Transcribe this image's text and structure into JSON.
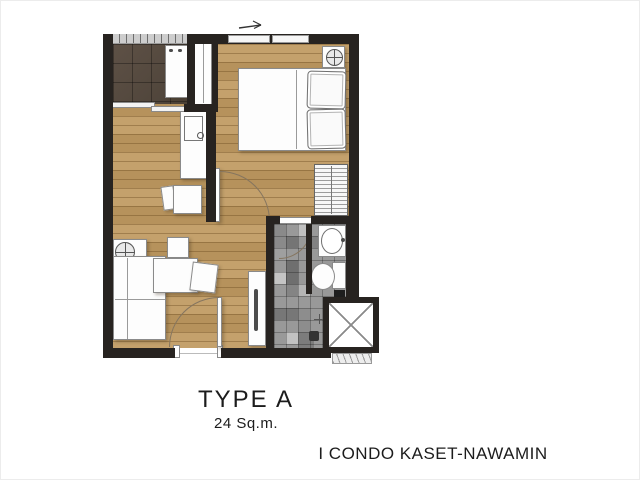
{
  "floor_plan": {
    "unit_type_label": "TYPE A",
    "unit_area_label": "24 Sq.m.",
    "project_name_label": "I CONDO KASET-NAWAMIN"
  },
  "colors": {
    "wall": "#272320",
    "wood_floor": "#c09a61",
    "balcony_tile": "#534840",
    "bathroom_tile": "#999999",
    "furniture_fill": "#fdfdfd",
    "door_arc": "#85755f",
    "text": "#1c1c1c"
  }
}
